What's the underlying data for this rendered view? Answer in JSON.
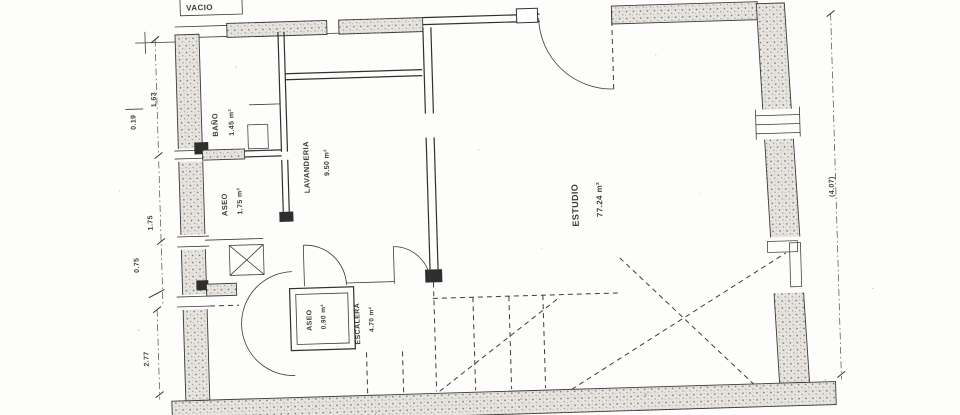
{
  "plan": {
    "rooms": [
      {
        "name": "ESTUDIO",
        "area": "77.24 m²"
      },
      {
        "name": "LAVANDERIA",
        "area": "9.50 m²"
      },
      {
        "name": "BAÑO",
        "area": "1.45 m²"
      },
      {
        "name": "ASEO",
        "area": "1.75 m²"
      },
      {
        "name": "ASEO",
        "area": "0.90 m²"
      },
      {
        "name": "ESCALERA",
        "area": "4.70 m²"
      }
    ],
    "dimensions": {
      "left_top": "1.63",
      "left_offset": "0.19",
      "left_mid": "1.75",
      "left_low": "0.75",
      "left_bottom": "2.77",
      "right_side": "(4.07)"
    },
    "annotations": {
      "top_partial": "VACIO"
    }
  },
  "colors": {
    "ink": "#2e2e2e",
    "wall_fill": "#e7e4df",
    "paper": "#fdfdfb"
  }
}
